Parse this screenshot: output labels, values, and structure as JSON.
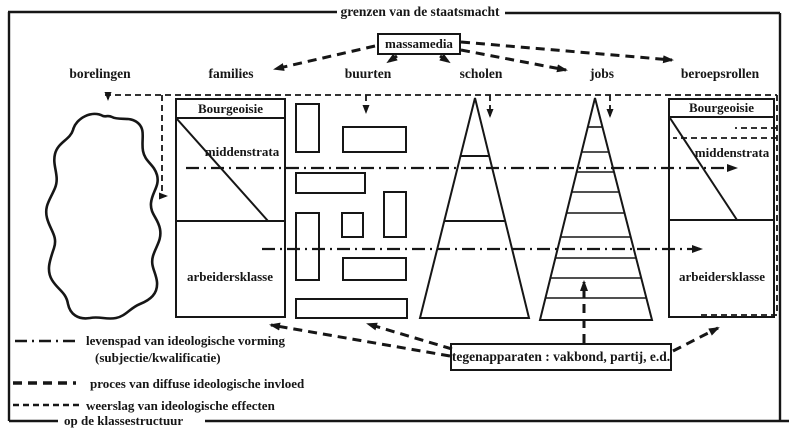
{
  "frame": {
    "title": "grenzen van de staatsmacht"
  },
  "massamedia": {
    "label": "massamedia"
  },
  "columns": [
    {
      "label": "borelingen"
    },
    {
      "label": "families"
    },
    {
      "label": "buurten"
    },
    {
      "label": "scholen"
    },
    {
      "label": "jobs"
    },
    {
      "label": "beroepsrollen"
    }
  ],
  "families_structure": {
    "top": "Bourgeoisie",
    "middle": "middenstrata",
    "bottom": "arbeidersklasse"
  },
  "beroepsrollen_structure": {
    "top": "Bourgeoisie",
    "middle": "middenstrata",
    "bottom": "arbeidersklasse"
  },
  "tegenapparaten": {
    "label": "tegenapparaten : vakbond, partij, e.d."
  },
  "legend": {
    "items": [
      {
        "style": "dash-dot",
        "label": "levenspad van ideologische vorming",
        "label2": "(subjectie/kwalificatie)"
      },
      {
        "style": "bold-dash",
        "label": "proces van diffuse ideologische invloed"
      },
      {
        "style": "fine-dash",
        "label": "weerslag van ideologische effecten",
        "label2": "op de klassestructuur"
      }
    ]
  },
  "colors": {
    "ink": "#161616",
    "paper": "#ffffff"
  }
}
